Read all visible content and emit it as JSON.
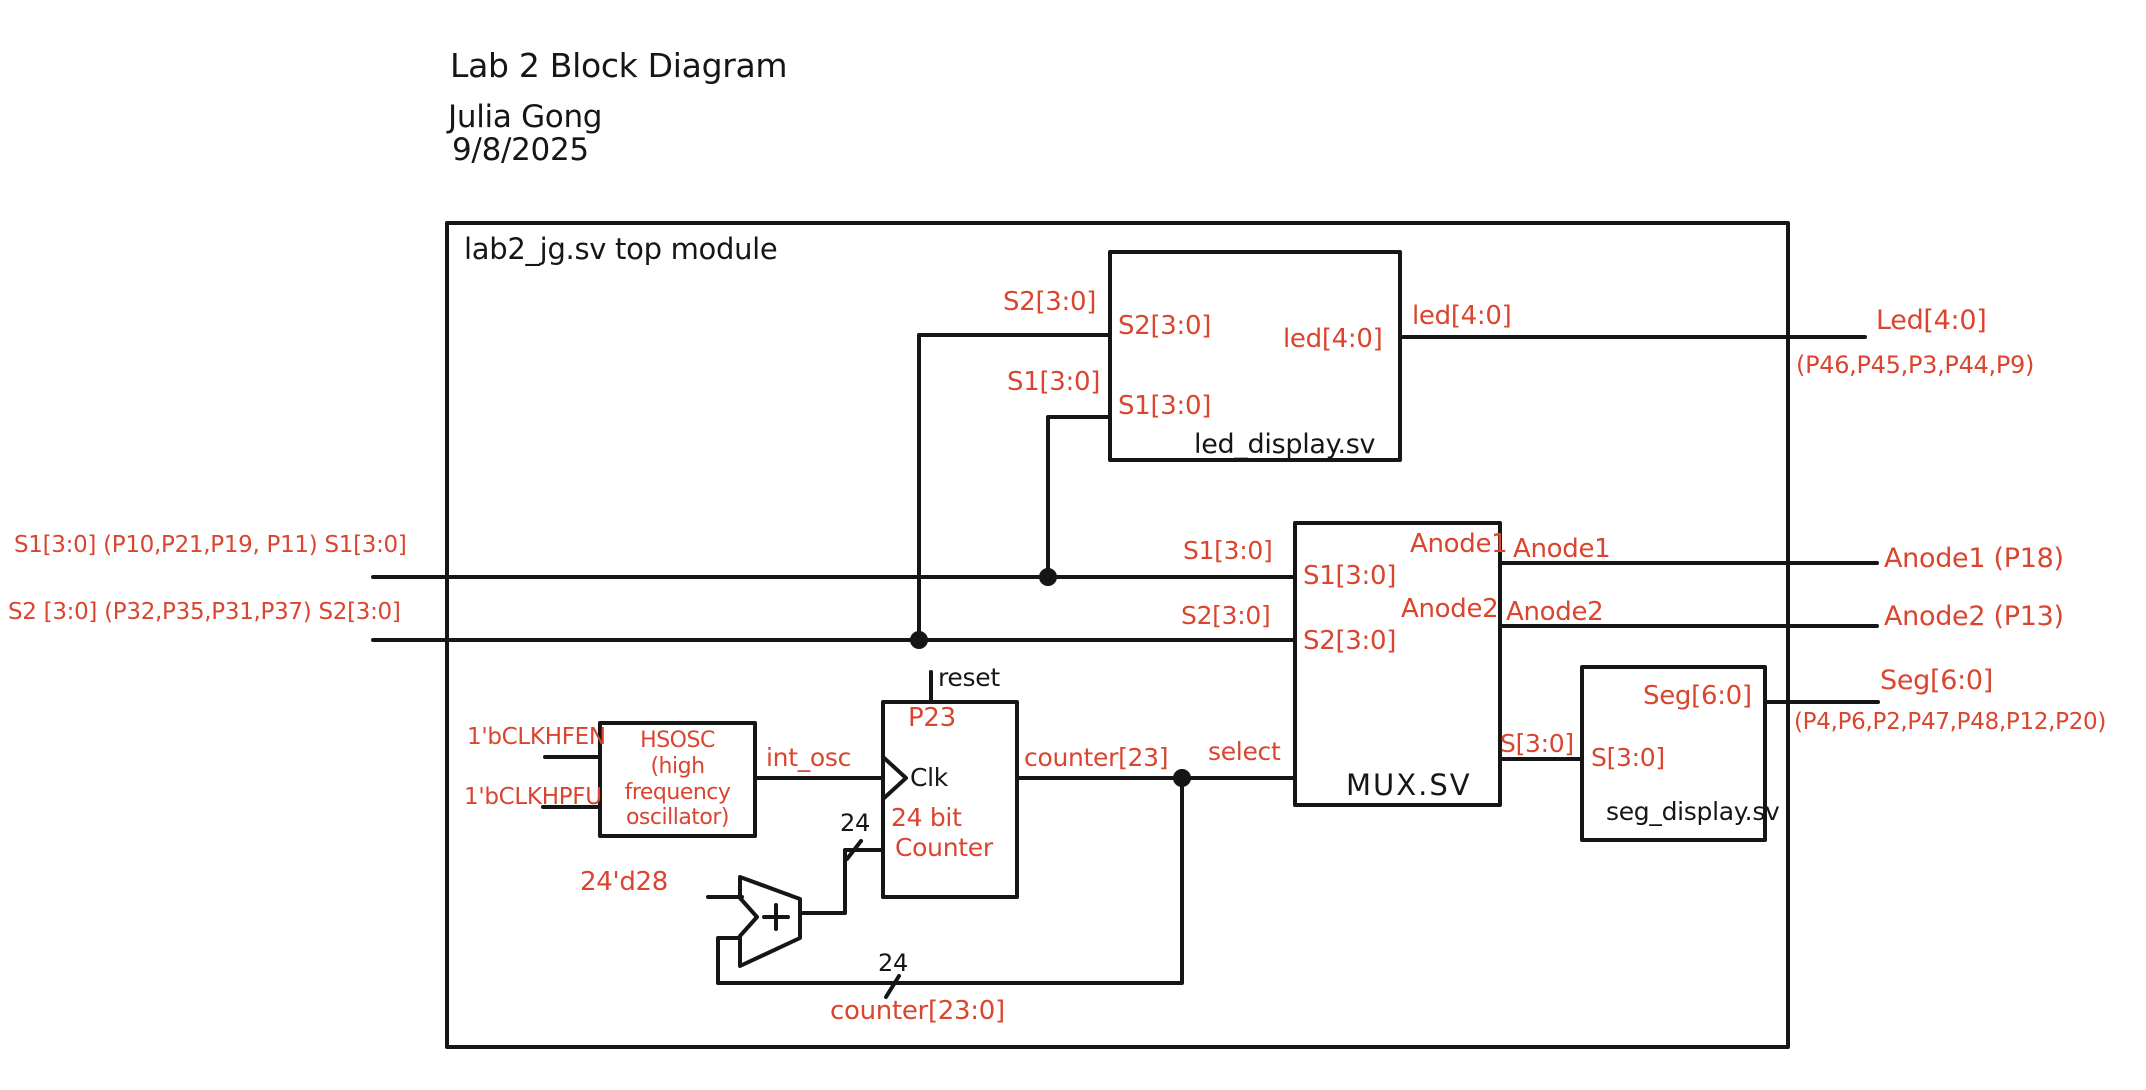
{
  "colors": {
    "ink": "#161616",
    "accent_red": "#d9452f"
  },
  "title_block": {
    "line1": "Lab 2 Block Diagram",
    "line2": "Julia Gong",
    "line3": "9/8/2025"
  },
  "top_module": {
    "label": "lab2_jg.sv top module"
  },
  "blocks": {
    "led_display": {
      "name": "led_display.sv",
      "in_s2": "S2[3:0]",
      "in_s1": "S1[3:0]",
      "out_led": "led[4:0]"
    },
    "mux": {
      "name": "MUX.SV",
      "in_s1": "S1[3:0]",
      "in_s2": "S2[3:0]",
      "out_anode1": "Anode1",
      "out_anode2": "Anode2"
    },
    "seg_display": {
      "name": "seg_display.sv",
      "in_s": "S[3:0]",
      "out_seg": "Seg[6:0]"
    },
    "hsosc": {
      "line1": "HSOSC",
      "line2": "(high frequency",
      "line3": "oscillator)"
    },
    "counter": {
      "reset_label": "reset",
      "reset_pin": "P23",
      "clk_label": "Clk",
      "line1": "24 bit",
      "line2": "Counter"
    }
  },
  "left_inputs": {
    "s1": "S1[3:0] (P10,P21,P19, P11) S1[3:0]",
    "s2": "S2 [3:0] (P32,P35,P31,P37) S2[3:0]"
  },
  "right_outputs": {
    "led": "Led[4:0]",
    "led_pins": "(P46,P45,P3,P44,P9)",
    "anode1": "Anode1 (P18)",
    "anode2": "Anode2 (P13)",
    "seg": "Seg[6:0]",
    "seg_pins": "(P4,P6,P2,P47,P48,P12,P20)"
  },
  "nets": {
    "s2_to_led": "S2[3:0]",
    "s1_to_led": "S1[3:0]",
    "led_out": "led[4:0]",
    "s1_to_mux": "S1[3:0]",
    "s2_to_mux": "S2[3:0]",
    "anode1_out": "Anode1",
    "anode2_out": "Anode2",
    "s_to_seg": "S[3:0]",
    "clkhfen": "1'bCLKHFEN",
    "clkhpfu": "1'bCLKHPFU",
    "int_osc": "int_osc",
    "counter_msb": "counter[23]",
    "select": "select",
    "const28": "24'd28",
    "width_in": "24",
    "width_fb": "24",
    "counter_bus": "counter[23:0]"
  }
}
